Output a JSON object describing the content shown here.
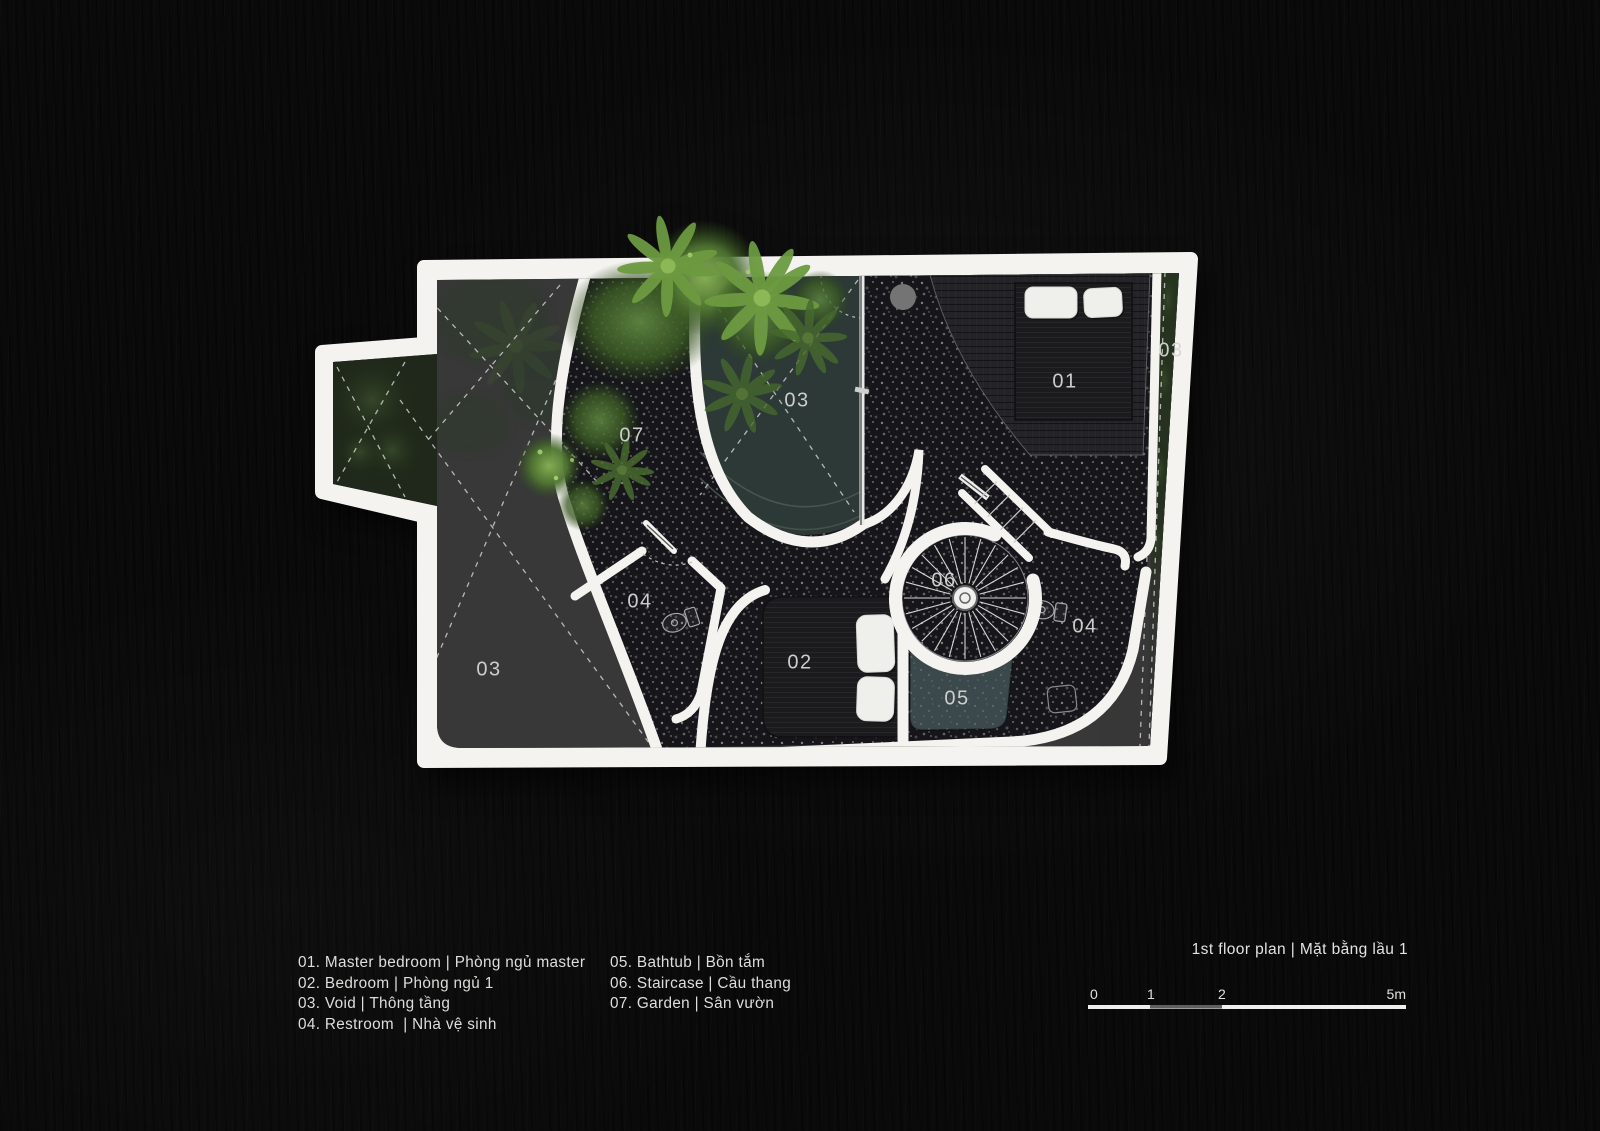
{
  "plan": {
    "labels": {
      "garden": "07",
      "void_top": "03",
      "master_bedroom": "01",
      "void_right": "03",
      "restroom_left": "04",
      "staircase": "06",
      "restroom_right": "04",
      "bedroom": "02",
      "bathtub": "05",
      "void_bottom_left": "03"
    }
  },
  "legend": {
    "column1": [
      "01. Master bedroom | Phòng ngủ master",
      "02. Bedroom | Phòng ngủ 1",
      "03. Void | Thông tầng",
      "04. Restroom  | Nhà vệ sinh"
    ],
    "column2": [
      "05. Bathtub | Bồn tắm",
      "06. Staircase | Cầu thang",
      "07. Garden | Sân vườn"
    ]
  },
  "footer": {
    "title": "1st floor plan | Mặt bằng lầu 1",
    "scale_ticks": [
      "0",
      "1",
      "2",
      "5m"
    ]
  },
  "colors": {
    "background": "#0a0a0a",
    "plan_wall": "#f4f3f0",
    "floor_speckle": "#17171b",
    "void_teal": "#2c3937",
    "bathtub_teal": "#3b484c",
    "foliage_green": "#6d9a40",
    "label_text": "#d6d6d4",
    "legend_text": "#dededc"
  }
}
